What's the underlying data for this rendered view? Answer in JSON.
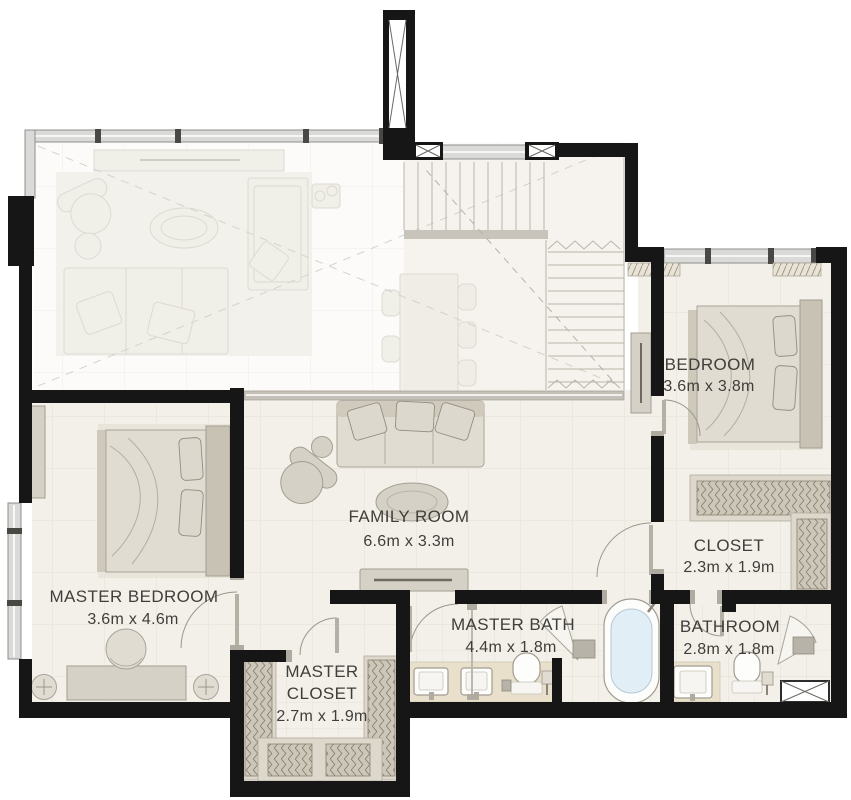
{
  "plan": {
    "rooms": {
      "bedroom": {
        "name": "BEDROOM",
        "dims": "3.6m x 3.8m"
      },
      "family_room": {
        "name": "FAMILY ROOM",
        "dims": "6.6m x 3.3m"
      },
      "closet": {
        "name": "CLOSET",
        "dims": "2.3m x 1.9m"
      },
      "master_bedroom": {
        "name": "MASTER BEDROOM",
        "dims": "3.6m x 4.6m"
      },
      "master_bath": {
        "name": "MASTER BATH",
        "dims": "4.4m x 1.8m"
      },
      "bathroom": {
        "name": "BATHROOM",
        "dims": "2.8m x 1.8m"
      },
      "master_closet": {
        "name_line1": "MASTER",
        "name_line2": "CLOSET",
        "dims": "2.7m x 1.9m"
      }
    },
    "colors": {
      "wall": "#161616",
      "floor": "#f3f0e9",
      "void_floor": "#fcfbf9",
      "window": "#dadad8",
      "furniture": "#d6d1c6",
      "counter": "#e9e0cb",
      "tub_water": "#e1eef5",
      "label": "#403e3a"
    }
  }
}
